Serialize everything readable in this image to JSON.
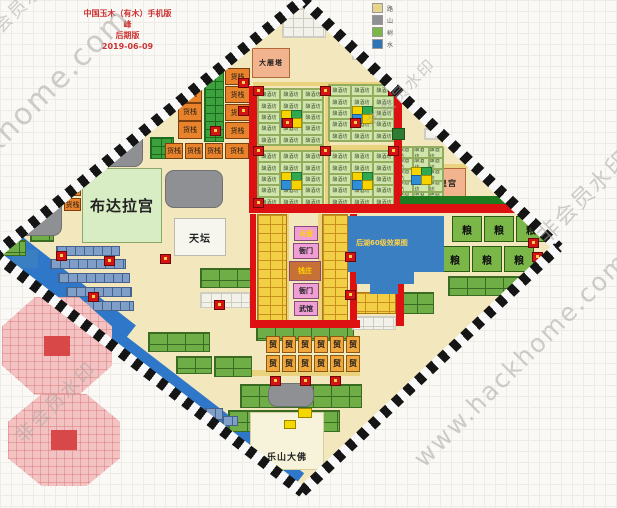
{
  "title": {
    "lines": [
      "中国玉木（有木）手机版",
      "峰",
      "后期版",
      "2019-06-09"
    ]
  },
  "legend": {
    "items": [
      {
        "label": "路",
        "color": "#e8d48a"
      },
      {
        "label": "山",
        "color": "#8f9093"
      },
      {
        "label": "树",
        "color": "#7ab648"
      },
      {
        "label": "水",
        "color": "#2e75b6"
      }
    ]
  },
  "watermarks": [
    {
      "text": "非会员水印",
      "x": -18,
      "y": 30,
      "size": 18,
      "rot": -45
    },
    {
      "text": "hackhome.com",
      "x": -55,
      "y": 175,
      "size": 30,
      "rot": -45
    },
    {
      "text": "非会员水印",
      "x": 368,
      "y": 112,
      "size": 16,
      "rot": -45
    },
    {
      "text": "非会员水印",
      "x": 540,
      "y": 222,
      "size": 22,
      "rot": -45
    },
    {
      "text": "www.hackhome.com",
      "x": 418,
      "y": 448,
      "size": 25,
      "rot": -45
    },
    {
      "text": "非会员水印",
      "x": 18,
      "y": 425,
      "size": 19,
      "rot": -45
    }
  ],
  "map": {
    "base_color": "#f3e7bd",
    "warehouse_label": "货栈",
    "cluster_cell_label": "酿酒坊",
    "trade_label": "贸",
    "grain_label": "粮",
    "lake_text": "后湖60级效果图",
    "landmarks": [
      {
        "id": "budalagong",
        "label": "布达拉宫",
        "x": 82,
        "y": 168,
        "w": 80,
        "h": 75,
        "bg": "#d9edc4",
        "border": "#8aa86a",
        "fs": 15
      },
      {
        "id": "tiantan",
        "label": "天坛",
        "x": 174,
        "y": 218,
        "w": 52,
        "h": 38,
        "bg": "#f6f6ef",
        "border": "#bbbbb0",
        "fs": 10
      },
      {
        "id": "dayanta",
        "label": "大雁塔",
        "x": 252,
        "y": 48,
        "w": 38,
        "h": 30,
        "bg": "#f2b48e",
        "border": "#b06a3a",
        "fs": 7
      },
      {
        "id": "huanggong",
        "label": "皇宫",
        "x": 430,
        "y": 168,
        "w": 36,
        "h": 30,
        "bg": "#f2b48e",
        "border": "#b06a3a",
        "fs": 8
      },
      {
        "id": "leshandafo",
        "label": "乐山大佛",
        "x": 250,
        "y": 412,
        "w": 74,
        "h": 58,
        "bg": "#f7f3da",
        "border": "#d8cfa0",
        "fs": 9,
        "label_bottom": true
      }
    ],
    "market_blocks": [
      {
        "label": "兵营",
        "x": 294,
        "y": 226,
        "w": 24,
        "h": 15,
        "bg": "#ef9ed6",
        "fg": "#ffd400"
      },
      {
        "label": "衙门",
        "x": 293,
        "y": 243,
        "w": 26,
        "h": 16,
        "bg": "#ef9ed6",
        "fg": "#222222"
      },
      {
        "label": "钱庄",
        "x": 289,
        "y": 261,
        "w": 32,
        "h": 20,
        "bg": "#c87137",
        "fg": "#ffd400"
      },
      {
        "label": "衙门",
        "x": 293,
        "y": 283,
        "w": 26,
        "h": 16,
        "bg": "#ef9ed6",
        "fg": "#222222"
      },
      {
        "label": "武馆",
        "x": 294,
        "y": 301,
        "w": 24,
        "h": 15,
        "bg": "#ef9ed6",
        "fg": "#222222"
      }
    ],
    "warehouses": [
      [
        225,
        68,
        25,
        17
      ],
      [
        225,
        86,
        25,
        17
      ],
      [
        225,
        104,
        25,
        17
      ],
      [
        225,
        122,
        25,
        17
      ],
      [
        178,
        85,
        24,
        18
      ],
      [
        178,
        103,
        24,
        18
      ],
      [
        178,
        121,
        24,
        18
      ],
      [
        155,
        95,
        19,
        17
      ],
      [
        165,
        143,
        18,
        16
      ],
      [
        185,
        143,
        18,
        16
      ],
      [
        205,
        143,
        18,
        16
      ],
      [
        225,
        143,
        24,
        16
      ],
      [
        64,
        183,
        17,
        13
      ],
      [
        64,
        198,
        17,
        13
      ]
    ],
    "clusters": [
      [
        257,
        88,
        66,
        57
      ],
      [
        328,
        84,
        66,
        57
      ],
      [
        257,
        150,
        66,
        57
      ],
      [
        328,
        150,
        66,
        57
      ],
      [
        397,
        146,
        46,
        56
      ]
    ],
    "trade_positions": [
      [
        266,
        336
      ],
      [
        282,
        336
      ],
      [
        298,
        336
      ],
      [
        314,
        336
      ],
      [
        330,
        336
      ],
      [
        346,
        336
      ],
      [
        266,
        355
      ],
      [
        282,
        355
      ],
      [
        298,
        355
      ],
      [
        314,
        355
      ],
      [
        330,
        355
      ],
      [
        346,
        355
      ]
    ],
    "grain_positions": [
      [
        452,
        216
      ],
      [
        484,
        216
      ],
      [
        516,
        216
      ],
      [
        440,
        246
      ],
      [
        472,
        246
      ],
      [
        504,
        246
      ]
    ],
    "mountains": [
      [
        95,
        117,
        48,
        50
      ],
      [
        0,
        196,
        62,
        40
      ],
      [
        165,
        170,
        58,
        38
      ],
      [
        268,
        383,
        46,
        24
      ]
    ],
    "trees": [
      [
        202,
        14
      ],
      [
        218,
        4
      ],
      [
        234,
        16
      ],
      [
        216,
        30
      ],
      [
        200,
        34
      ],
      [
        243,
        26
      ],
      [
        262,
        10
      ],
      [
        392,
        128
      ]
    ],
    "red_minis": [
      [
        238,
        78
      ],
      [
        238,
        106
      ],
      [
        210,
        126
      ],
      [
        253,
        86
      ],
      [
        253,
        146
      ],
      [
        253,
        198
      ],
      [
        320,
        86
      ],
      [
        320,
        146
      ],
      [
        388,
        86
      ],
      [
        388,
        146
      ],
      [
        282,
        118
      ],
      [
        350,
        118
      ],
      [
        345,
        252
      ],
      [
        345,
        290
      ],
      [
        270,
        376
      ],
      [
        300,
        376
      ],
      [
        330,
        376
      ],
      [
        56,
        251
      ],
      [
        104,
        256
      ],
      [
        88,
        292
      ],
      [
        160,
        254
      ],
      [
        528,
        238
      ],
      [
        532,
        252
      ],
      [
        404,
        76
      ],
      [
        214,
        300
      ]
    ],
    "yellow_minis": [
      [
        298,
        408,
        14,
        10
      ],
      [
        284,
        420,
        12,
        9
      ],
      [
        534,
        268,
        12,
        10
      ]
    ],
    "red_roads": [
      [
        249,
        86,
        8,
        126
      ],
      [
        394,
        92,
        8,
        120
      ],
      [
        249,
        204,
        286,
        9
      ],
      [
        250,
        214,
        6,
        112
      ],
      [
        350,
        214,
        7,
        112
      ],
      [
        250,
        320,
        110,
        8
      ],
      [
        396,
        246,
        8,
        80
      ]
    ],
    "roads": [
      [
        253,
        82,
        145,
        4
      ],
      [
        257,
        145,
        137,
        5
      ],
      [
        325,
        88,
        5,
        118
      ],
      [
        285,
        214,
        4,
        112
      ],
      [
        318,
        214,
        4,
        112
      ],
      [
        252,
        370,
        108,
        6
      ],
      [
        424,
        164,
        48,
        4
      ],
      [
        424,
        200,
        48,
        4
      ]
    ],
    "pattern_areas": [
      {
        "cls": "cells-minigreen",
        "x": 204,
        "y": 64,
        "w": 20,
        "h": 78
      },
      {
        "cls": "cells-minigreen",
        "x": 140,
        "y": 63,
        "w": 35,
        "h": 20
      },
      {
        "cls": "cells-minigreen",
        "x": 150,
        "y": 137,
        "w": 24,
        "h": 22
      },
      {
        "cls": "cells-yellow",
        "x": 257,
        "y": 214,
        "w": 30,
        "h": 108
      },
      {
        "cls": "cells-yellow",
        "x": 322,
        "y": 214,
        "w": 26,
        "h": 108
      },
      {
        "cls": "cells-green",
        "x": 256,
        "y": 326,
        "w": 98,
        "h": 15
      },
      {
        "cls": "cells-green",
        "x": 214,
        "y": 356,
        "w": 38,
        "h": 21
      },
      {
        "cls": "cells-green",
        "x": 240,
        "y": 384,
        "w": 122,
        "h": 24
      },
      {
        "cls": "cells-green",
        "x": 228,
        "y": 410,
        "w": 112,
        "h": 22
      },
      {
        "cls": "cells-green",
        "x": 448,
        "y": 276,
        "w": 84,
        "h": 20
      },
      {
        "cls": "cells-green",
        "x": 200,
        "y": 268,
        "w": 52,
        "h": 20
      },
      {
        "cls": "cells-green",
        "x": 148,
        "y": 332,
        "w": 62,
        "h": 20
      },
      {
        "cls": "cells-green",
        "x": 176,
        "y": 356,
        "w": 36,
        "h": 18
      },
      {
        "cls": "cells-green",
        "x": 398,
        "y": 292,
        "w": 36,
        "h": 22
      },
      {
        "cls": "cells-white",
        "x": 200,
        "y": 292,
        "w": 50,
        "h": 16
      },
      {
        "cls": "cells-white",
        "x": 352,
        "y": 44,
        "w": 46,
        "h": 16
      },
      {
        "cls": "cells-white",
        "x": 282,
        "y": 8,
        "w": 44,
        "h": 30
      },
      {
        "cls": "cells-white",
        "x": 424,
        "y": 128,
        "w": 30,
        "h": 12
      },
      {
        "cls": "cells-white",
        "x": 352,
        "y": 316,
        "w": 44,
        "h": 14
      },
      {
        "cls": "cells-yellow",
        "x": 352,
        "y": 292,
        "w": 44,
        "h": 22
      },
      {
        "cls": "cells-green",
        "x": 370,
        "y": 62,
        "w": 40,
        "h": 12
      },
      {
        "cls": "cells-green",
        "x": 456,
        "y": 132,
        "w": 16,
        "h": 12
      },
      {
        "cls": "cells-green",
        "x": 30,
        "y": 228,
        "w": 24,
        "h": 14
      },
      {
        "cls": "cells-green",
        "x": 0,
        "y": 240,
        "w": 26,
        "h": 16
      },
      {
        "cls": "cells-slate",
        "x": 205,
        "y": 408,
        "w": 18,
        "h": 12
      },
      {
        "cls": "cells-slate",
        "x": 222,
        "y": 416,
        "w": 16,
        "h": 10
      }
    ],
    "dock_rows": [
      [
        56,
        246,
        64,
        10
      ],
      [
        50,
        259,
        76,
        10
      ],
      [
        58,
        273,
        72,
        10
      ],
      [
        66,
        287,
        66,
        10
      ],
      [
        74,
        301,
        60,
        10
      ]
    ],
    "water_bars": [
      {
        "x": -5,
        "y": 368,
        "w": 330,
        "h": 44,
        "rot": 37.6
      },
      {
        "x": -25,
        "y": 270,
        "w": 160,
        "h": 58,
        "rot": 38
      }
    ],
    "small_lakes": [
      [
        12,
        250,
        26,
        18
      ]
    ],
    "lake": {
      "x": 348,
      "y": 216,
      "w": 96,
      "h": 56,
      "sub": [
        [
          356,
          270,
          58,
          14
        ],
        [
          370,
          284,
          28,
          10
        ]
      ]
    },
    "dark_green_strip": [
      400,
      196,
      134,
      8
    ]
  }
}
